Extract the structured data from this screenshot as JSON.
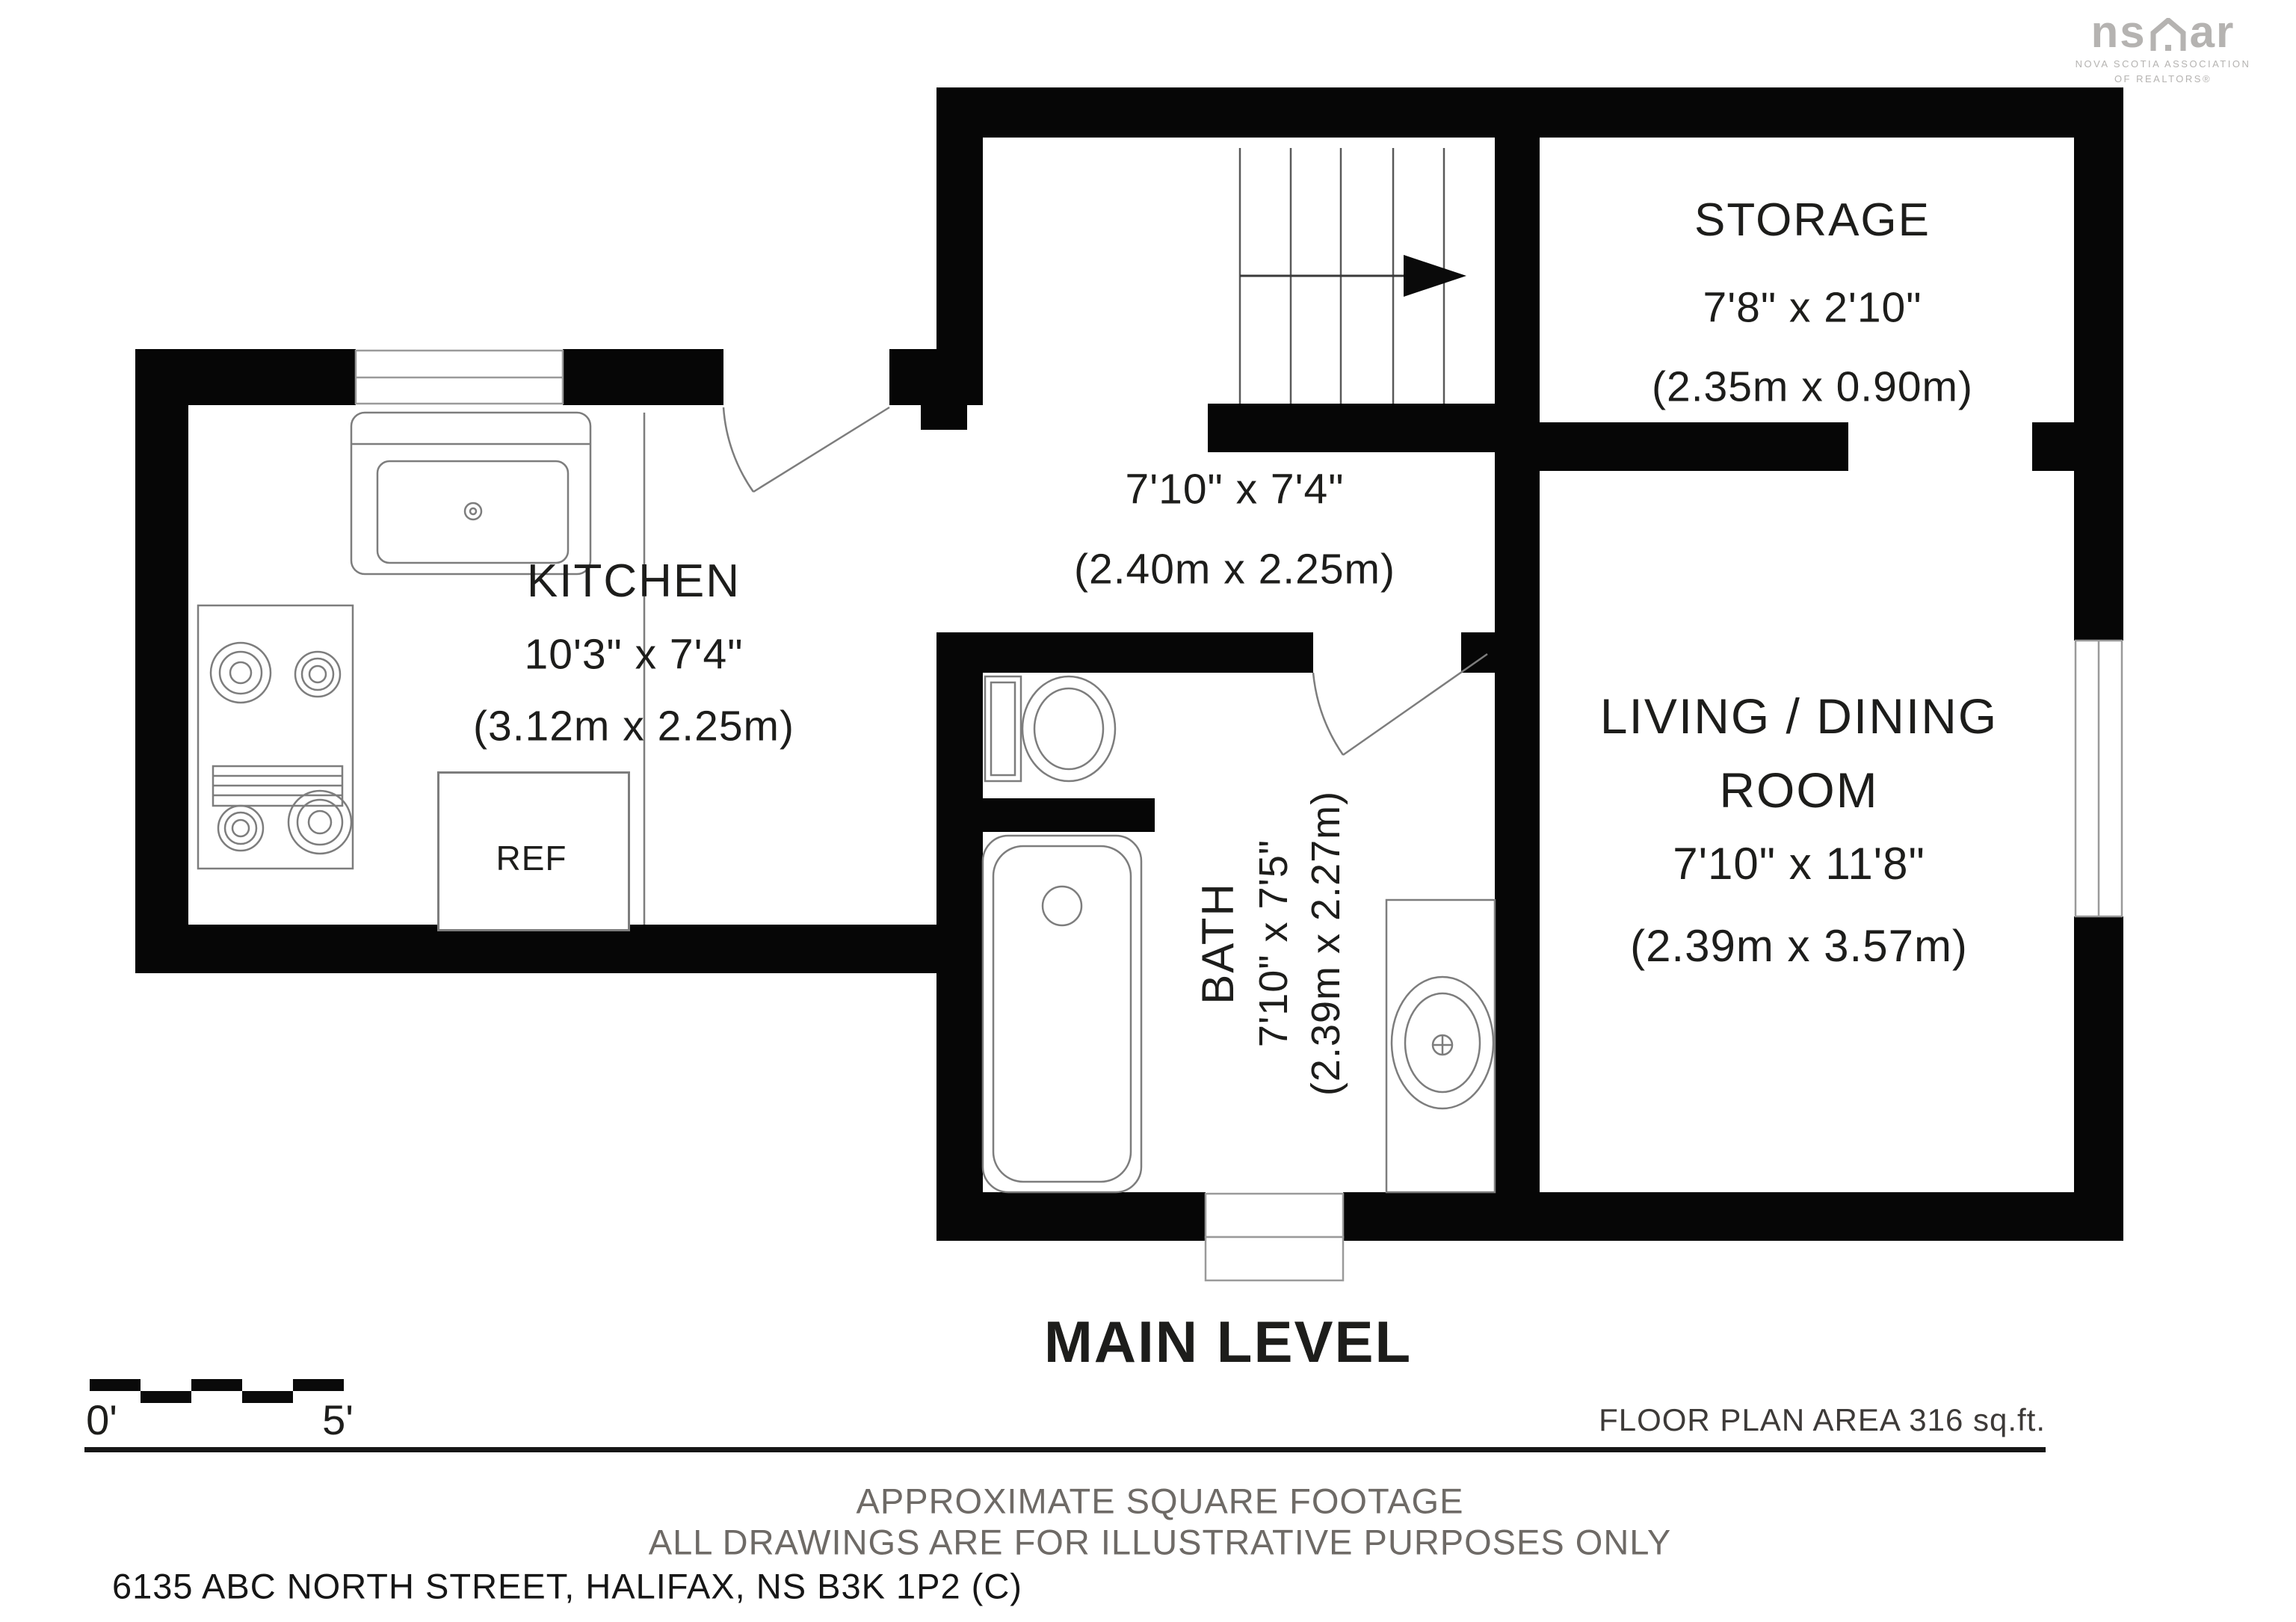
{
  "logo": {
    "mark_left": "ns",
    "mark_right": "ar",
    "caption_line1": "NOVA SCOTIA ASSOCIATION",
    "caption_line2": "OF REALTORS®"
  },
  "rooms": {
    "storage": {
      "name": "STORAGE",
      "imperial": "7'8\" x 2'10\"",
      "metric": "(2.35m x 0.90m)"
    },
    "hall": {
      "imperial": "7'10\" x 7'4\"",
      "metric": "(2.40m x 2.25m)"
    },
    "kitchen": {
      "name": "KITCHEN",
      "imperial": "10'3\" x 7'4\"",
      "metric": "(3.12m x 2.25m)"
    },
    "bath": {
      "name": "BATH",
      "imperial": "7'10\" x 7'5\"",
      "metric": "(2.39m x 2.27m)"
    },
    "living": {
      "name_line1": "LIVING / DINING",
      "name_line2": "ROOM",
      "imperial": "7'10\" x 11'8\"",
      "metric": "(2.39m x 3.57m)"
    }
  },
  "fixtures": {
    "fridge_label": "REF"
  },
  "title": "MAIN LEVEL",
  "scale_bar": {
    "start_label": "0'",
    "end_label": "5'"
  },
  "footer": {
    "area_note": "FLOOR PLAN AREA 316 sq.ft.",
    "disclaimer_line1": "APPROXIMATE SQUARE FOOTAGE",
    "disclaimer_line2": "ALL DRAWINGS ARE FOR ILLUSTRATIVE PURPOSES ONLY",
    "address": "6135 ABC NORTH STREET, HALIFAX, NS B3K 1P2 (C)"
  },
  "colors": {
    "wall": "#060606",
    "background": "#ffffff",
    "fixture_line": "#878787",
    "text": "#1d1d1b",
    "muted_text": "#6e6a66",
    "logo": "#b5b3b1"
  }
}
